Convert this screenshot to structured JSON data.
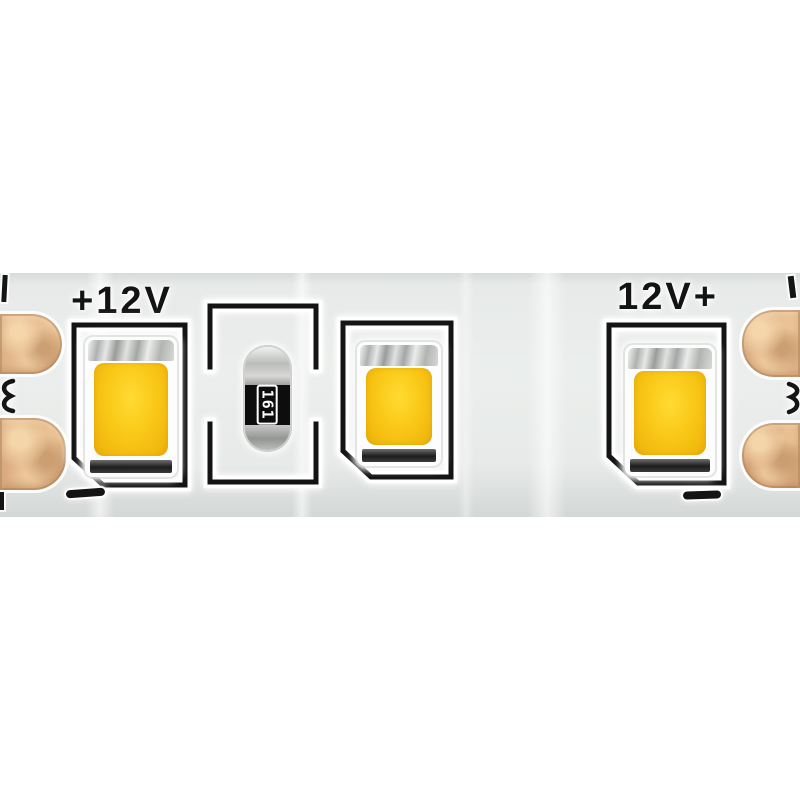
{
  "photo": {
    "subject": "12V LED strip segment close-up",
    "background_color": "#ffffff",
    "pcb_color": "#e7eae8",
    "silkscreen_color": "#141414",
    "copper_pad_color": "#e1b68b",
    "led_phosphor_color": "#f7c613",
    "labels": {
      "left_voltage": "+12V",
      "right_voltage": "12V+"
    },
    "resistor": {
      "code": "161"
    },
    "polarity_marks": {
      "negative_left": "-",
      "negative_right": "-"
    },
    "components": {
      "leds": 3,
      "resistors": 1,
      "solder_pads_left": 2,
      "solder_pads_right": 2
    }
  }
}
